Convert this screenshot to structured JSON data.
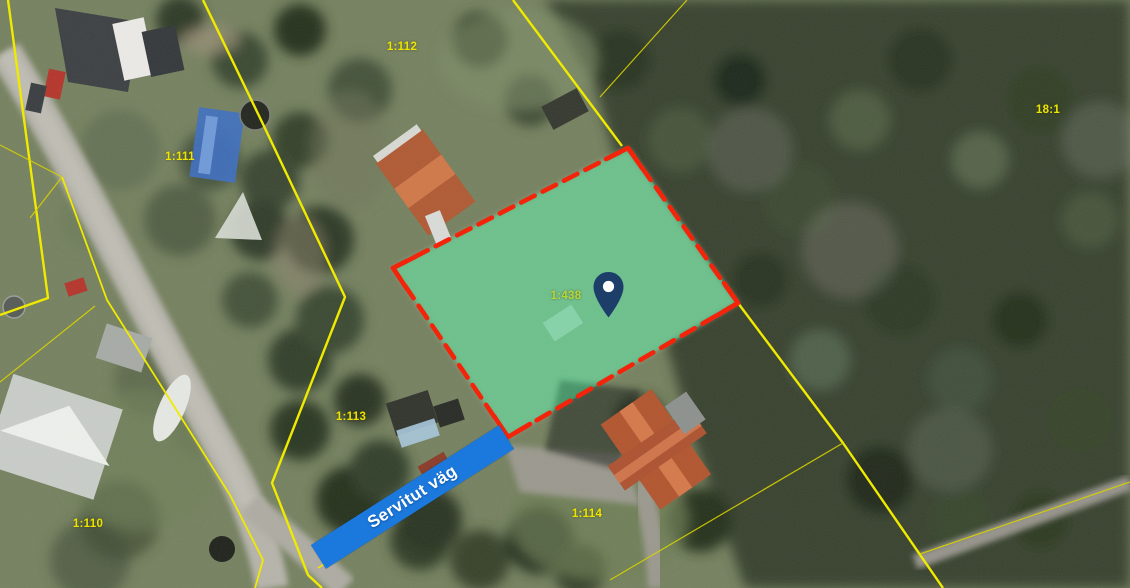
{
  "map": {
    "parcel_labels": [
      {
        "text": "1:112",
        "x": 402,
        "y": 47
      },
      {
        "text": "1:111",
        "x": 180,
        "y": 157
      },
      {
        "text": "18:1",
        "x": 1048,
        "y": 110
      },
      {
        "text": "1:438",
        "x": 566,
        "y": 296,
        "color": "#b9d43c"
      },
      {
        "text": "1:113",
        "x": 351,
        "y": 417
      },
      {
        "text": "1:114",
        "x": 587,
        "y": 514
      },
      {
        "text": "1:110",
        "x": 88,
        "y": 524
      }
    ],
    "label_color": "#ede400",
    "highlighted_parcel": {
      "label": "1:438",
      "fill": "#3cd48c",
      "border_color": "#f3240a"
    },
    "easement": {
      "label": "Servitut väg",
      "bar_color": "#1b79dd",
      "text_color": "#ffffff"
    },
    "pin": {
      "color": "#1d3e68"
    },
    "boundary_line_color": "#f0ea00",
    "boundary_line_faint_color": "#d6d200"
  }
}
